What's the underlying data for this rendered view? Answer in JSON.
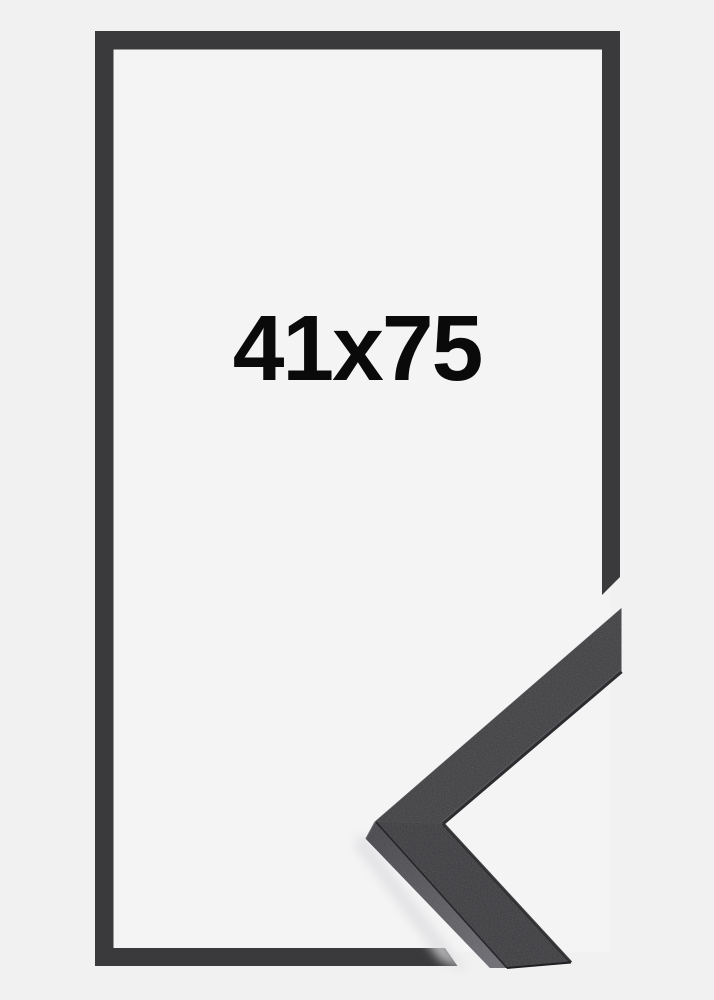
{
  "product_image": {
    "size_label": "41x75",
    "colors": {
      "background": "#f1f1f2",
      "inner_background": "#f4f4f5",
      "frame": "#3a3a3c",
      "label_text": "#0a0a0a",
      "sample_face_top": "#3e3e41",
      "sample_face_bottom": "#3a3a3e",
      "sample_side_dark": "#45454a",
      "sample_side_light": "#6d6d73",
      "sample_lip": "#2c2c2f",
      "sample_bevel": "#5a5a60",
      "sample_seam": "#202023",
      "sample_miter_seam": "#4f4f54",
      "sample_edge_highlight": "#4c4c51",
      "shadow": "#dedee0"
    }
  }
}
